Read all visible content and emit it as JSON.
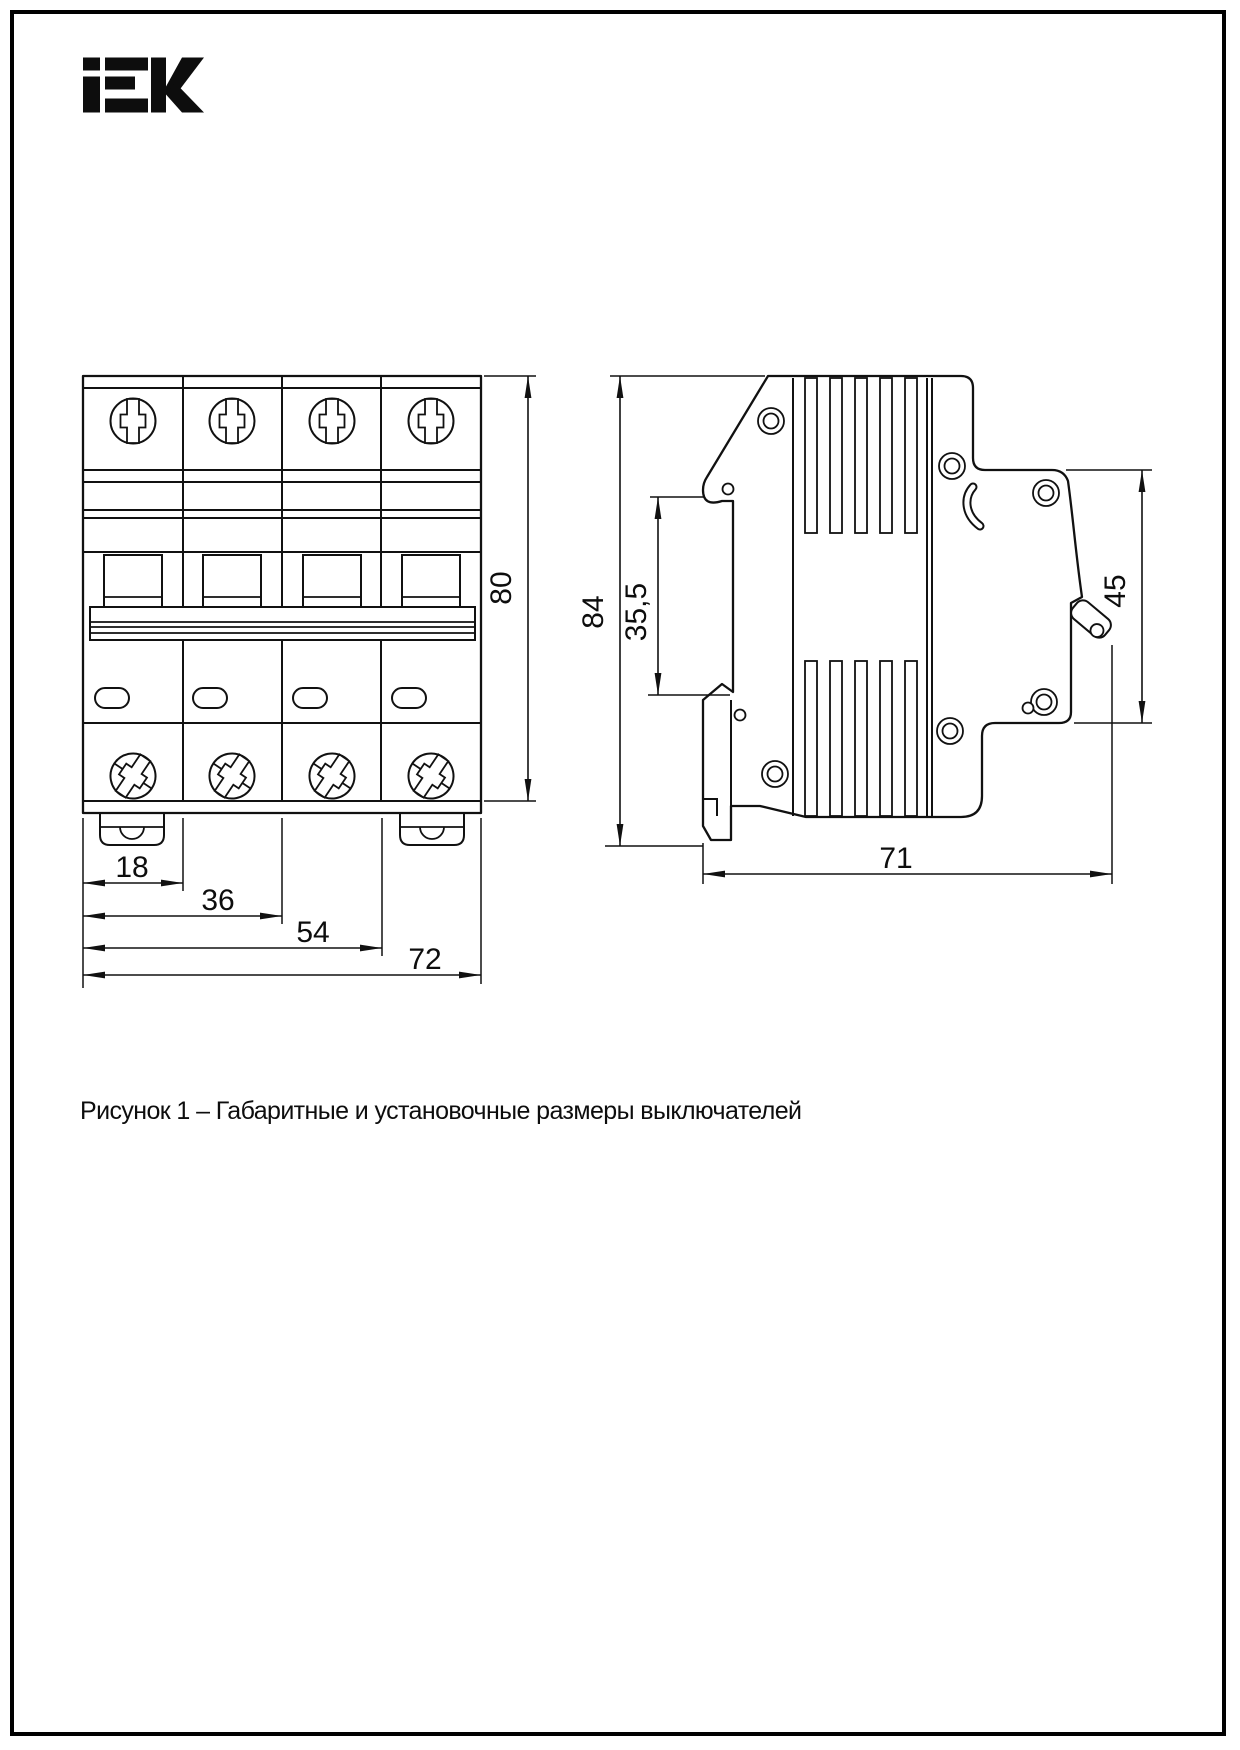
{
  "ink": "#111111",
  "logo": {
    "text": "iEK"
  },
  "caption": {
    "text": "Рисунок 1 – Габаритные и установочные размеры выключателей"
  },
  "front_view": {
    "title": "Габаритные размеры — вид спереди",
    "dims": {
      "w18": "18",
      "w36": "36",
      "w54": "54",
      "w72": "72",
      "h80": "80"
    }
  },
  "side_view": {
    "title": "Габаритные размеры — вид сбоку",
    "dims": {
      "h84": "84",
      "din355": "35,5",
      "h45": "45",
      "d71": "71"
    }
  }
}
